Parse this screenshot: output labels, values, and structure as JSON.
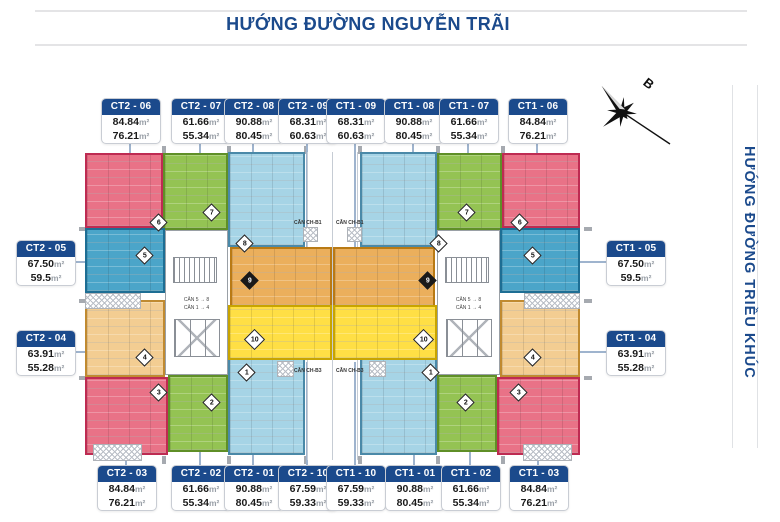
{
  "header": {
    "title": "HƯỚNG ĐƯỜNG NGUYỄN TRÃI"
  },
  "side": {
    "title": "HƯỚNG ĐƯỜNG TRIỀU KHÚC"
  },
  "compass": {
    "label": "B"
  },
  "floor_plan": {
    "area_unit": "m²",
    "bridge_labels": [
      "CĂN CH-B1",
      "CĂN CH-B1",
      "CĂN CH-B3",
      "CĂN CH-B3"
    ],
    "core_labels": [
      "CĂN 5 → 8",
      "CĂN 1 → 4"
    ],
    "units": [
      {
        "id": "CT2 - 06",
        "number": "6",
        "areas": [
          "84.84",
          "76.21"
        ],
        "color": "pink"
      },
      {
        "id": "CT2 - 07",
        "number": "7",
        "areas": [
          "61.66",
          "55.34"
        ],
        "color": "green"
      },
      {
        "id": "CT2 - 08",
        "number": "8",
        "areas": [
          "90.88",
          "80.45"
        ],
        "color": "lightblue"
      },
      {
        "id": "CT2 - 09",
        "number": "9",
        "areas": [
          "68.31",
          "60.63"
        ],
        "color": "orange"
      },
      {
        "id": "CT1 - 09",
        "number": "9",
        "areas": [
          "68.31",
          "60.63"
        ],
        "color": "orange"
      },
      {
        "id": "CT1 - 08",
        "number": "8",
        "areas": [
          "90.88",
          "80.45"
        ],
        "color": "lightblue"
      },
      {
        "id": "CT1 - 07",
        "number": "7",
        "areas": [
          "61.66",
          "55.34"
        ],
        "color": "green"
      },
      {
        "id": "CT1 - 06",
        "number": "6",
        "areas": [
          "84.84",
          "76.21"
        ],
        "color": "pink"
      },
      {
        "id": "CT2 - 05",
        "number": "5",
        "areas": [
          "67.50",
          "59.5"
        ],
        "color": "medblue"
      },
      {
        "id": "CT2 - 04",
        "number": "4",
        "areas": [
          "63.91",
          "55.28"
        ],
        "color": "tan"
      },
      {
        "id": "CT1 - 05",
        "number": "5",
        "areas": [
          "67.50",
          "59.5"
        ],
        "color": "medblue"
      },
      {
        "id": "CT1 - 04",
        "number": "4",
        "areas": [
          "63.91",
          "55.28"
        ],
        "color": "tan"
      },
      {
        "id": "CT2 - 03",
        "number": "3",
        "areas": [
          "84.84",
          "76.21"
        ],
        "color": "pink"
      },
      {
        "id": "CT2 - 02",
        "number": "2",
        "areas": [
          "61.66",
          "55.34"
        ],
        "color": "green"
      },
      {
        "id": "CT2 - 01",
        "number": "1",
        "areas": [
          "90.88",
          "80.45"
        ],
        "color": "lightblue"
      },
      {
        "id": "CT2 - 10",
        "number": "10",
        "areas": [
          "67.59",
          "59.33"
        ],
        "color": "yellow"
      },
      {
        "id": "CT1 - 10",
        "number": "10",
        "areas": [
          "67.59",
          "59.33"
        ],
        "color": "yellow"
      },
      {
        "id": "CT1 - 01",
        "number": "1",
        "areas": [
          "90.88",
          "80.45"
        ],
        "color": "lightblue"
      },
      {
        "id": "CT1 - 02",
        "number": "2",
        "areas": [
          "61.66",
          "55.34"
        ],
        "color": "green"
      },
      {
        "id": "CT1 - 03",
        "number": "3",
        "areas": [
          "84.84",
          "76.21"
        ],
        "color": "pink"
      }
    ]
  },
  "colors": {
    "navy": "#1B4A8C",
    "pink": {
      "fill": "#E97287",
      "border": "#BE2B52"
    },
    "green": {
      "fill": "#94C353",
      "border": "#5F8F27"
    },
    "lightblue": {
      "fill": "#A6D4E6",
      "border": "#4A89A8"
    },
    "medblue": {
      "fill": "#4BA5C9",
      "border": "#1D6E94"
    },
    "tan": {
      "fill": "#F3CD92",
      "border": "#C08A30"
    },
    "orange": {
      "fill": "#EBAF5C",
      "border": "#B97A14"
    },
    "yellow": {
      "fill": "#FFDF45",
      "border": "#C8A400"
    }
  }
}
